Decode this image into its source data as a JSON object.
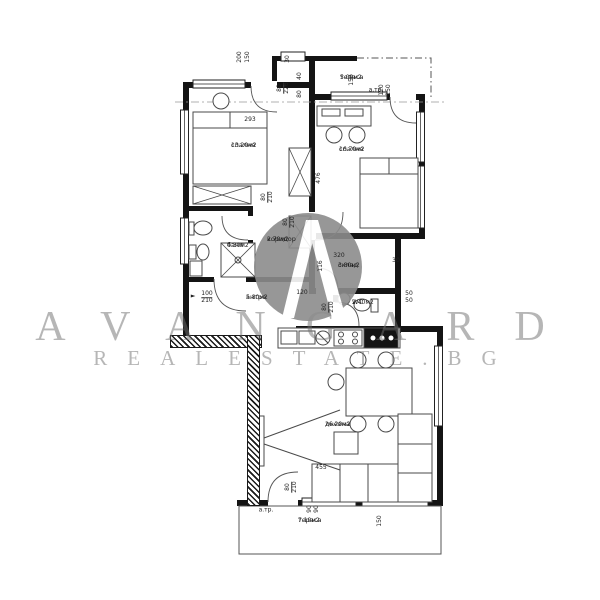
{
  "watermark": {
    "brand": "AVANGARD",
    "domain": "REALESTATE.BG",
    "logo_letter": "A",
    "text_color": "#6f6f6f",
    "logo_color": "#8c8c8c"
  },
  "plan": {
    "wall_color": "#141414",
    "line_color": "#4a4a4a"
  },
  "rooms": [
    {
      "name": "тераса",
      "area": "5.00м2",
      "x": 340,
      "y": 74
    },
    {
      "name": "спалня",
      "area": "13.20м2",
      "x": 231,
      "y": 142
    },
    {
      "name": "спалня",
      "area": "16.70м2",
      "x": 339,
      "y": 146
    },
    {
      "name": "баня",
      "area": "4.30м2",
      "x": 227,
      "y": 242
    },
    {
      "name": "коридор",
      "area": "2.70м2",
      "x": 267,
      "y": 236
    },
    {
      "name": "склад",
      "area": "3.80м2",
      "x": 338,
      "y": 262
    },
    {
      "name": "антре",
      "area": "5.80м2",
      "x": 246,
      "y": 294
    },
    {
      "name": "WC",
      "area": "2.40м2",
      "x": 352,
      "y": 299
    },
    {
      "name": "дневна",
      "area": "26.20м2",
      "x": 325,
      "y": 421
    },
    {
      "name": "тераса",
      "area": "7.10м2",
      "x": 298,
      "y": 517
    }
  ],
  "dimensions": [
    {
      "t": "200",
      "x": 240,
      "y": 57,
      "rot": 90
    },
    {
      "t": "150",
      "x": 248,
      "y": 57,
      "rot": 90
    },
    {
      "t": "30",
      "x": 288,
      "y": 59,
      "rot": 90
    },
    {
      "t": "40",
      "x": 300,
      "y": 76,
      "rot": 90
    },
    {
      "t": "80",
      "x": 300,
      "y": 94,
      "rot": 90
    },
    {
      "t": "80",
      "t2": "226",
      "x": 284,
      "y": 88,
      "rot": 90
    },
    {
      "t": "150",
      "x": 352,
      "y": 80,
      "rot": 90
    },
    {
      "t": "120",
      "x": 382,
      "y": 90,
      "rot": 90
    },
    {
      "t": "150",
      "x": 389,
      "y": 90,
      "rot": 90
    },
    {
      "t": "293",
      "x": 250,
      "y": 120,
      "rot": 0
    },
    {
      "t": "476",
      "x": 319,
      "y": 178,
      "rot": 90
    },
    {
      "t": "80",
      "t2": "210",
      "x": 268,
      "y": 197,
      "rot": 90
    },
    {
      "t": "80",
      "t2": "210",
      "x": 290,
      "y": 222,
      "rot": 90
    },
    {
      "t": "320",
      "x": 339,
      "y": 256,
      "rot": 0
    },
    {
      "t": "116",
      "x": 321,
      "y": 266,
      "rot": 90
    },
    {
      "t": "30",
      "x": 396,
      "y": 261,
      "rot": 0
    },
    {
      "t": "100",
      "t2": "210",
      "x": 207,
      "y": 298,
      "rot": 0
    },
    {
      "t": "120",
      "x": 302,
      "y": 293,
      "rot": 0
    },
    {
      "t": "80",
      "t2": "210",
      "x": 329,
      "y": 307,
      "rot": 90
    },
    {
      "t": "50",
      "x": 409,
      "y": 294,
      "rot": 0
    },
    {
      "t": "50",
      "x": 409,
      "y": 301,
      "rot": 0
    },
    {
      "t": "455",
      "x": 321,
      "y": 468,
      "rot": 0
    },
    {
      "t": "80",
      "t2": "210",
      "x": 292,
      "y": 487,
      "rot": 90
    },
    {
      "t": "90",
      "x": 310,
      "y": 509,
      "rot": 90
    },
    {
      "t": "90",
      "x": 317,
      "y": 509,
      "rot": 90
    },
    {
      "t": "150",
      "x": 380,
      "y": 521,
      "rot": 90
    }
  ],
  "annotations": [
    {
      "t": "а.тр.",
      "x": 376,
      "y": 90
    },
    {
      "t": "а.тр.",
      "x": 266,
      "y": 510
    },
    {
      "t": "►",
      "x": 193,
      "y": 296
    }
  ]
}
